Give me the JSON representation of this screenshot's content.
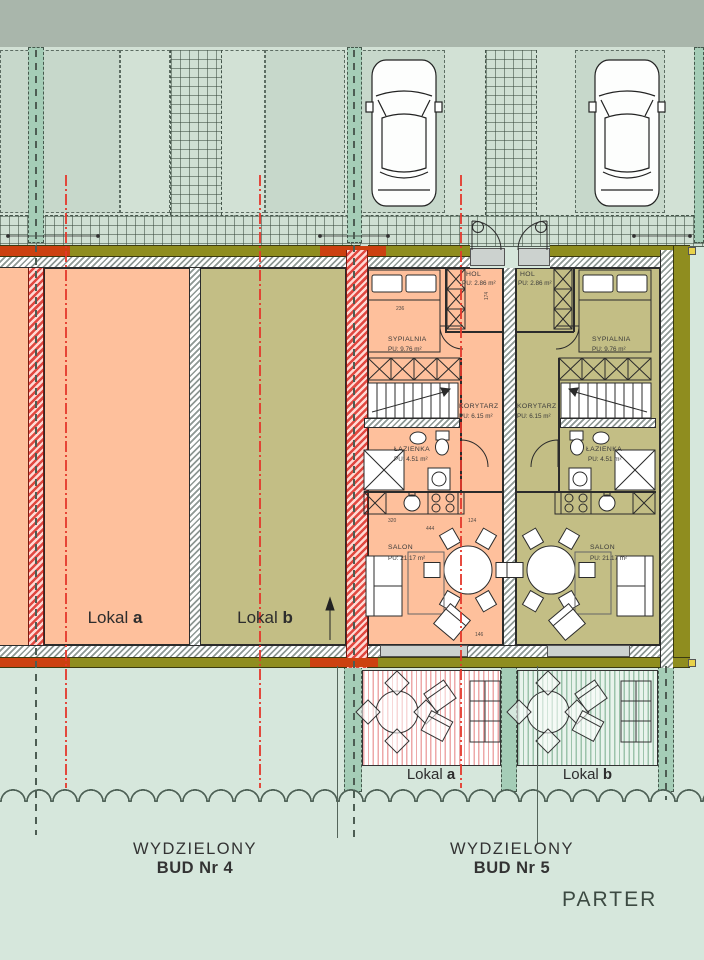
{
  "title": "PARTER",
  "buildings": {
    "bud4": {
      "caption_line1": "WYDZIELONY",
      "caption_line2": "BUD Nr 4",
      "units": [
        {
          "label": "Lokal",
          "letter": "a"
        },
        {
          "label": "Lokal",
          "letter": "b"
        }
      ]
    },
    "bud5": {
      "caption_line1": "WYDZIELONY",
      "caption_line2": "BUD Nr 5",
      "terrace_units": [
        {
          "label": "Lokal",
          "letter": "a"
        },
        {
          "label": "Lokal",
          "letter": "b"
        }
      ],
      "rooms": {
        "hol": {
          "name": "HOL",
          "area": "PU: 2.86 m²"
        },
        "sypialnia": {
          "name": "SYPIALNIA",
          "area": "PU: 9.76 m²"
        },
        "korytarz": {
          "name": "KORYTARZ",
          "area": "PU: 6.15 m²"
        },
        "lazienka": {
          "name": "ŁAZIENKA",
          "area": "PU: 4.51 m²"
        },
        "salon": {
          "name": "SALON",
          "area": "PU: 21.17 m²"
        }
      }
    }
  },
  "dims": [
    "174",
    "236",
    "320",
    "444",
    "124",
    "146"
  ],
  "colors": {
    "salmon": "#fec09c",
    "olive": "#c3be85",
    "olive_band": "#8f8d1f",
    "red_band": "#cc4110",
    "axis_red": "#e4372b",
    "teal_post": "#a5cdb7",
    "background": "#d6e7dc",
    "top_band": "#a9b6ab"
  }
}
